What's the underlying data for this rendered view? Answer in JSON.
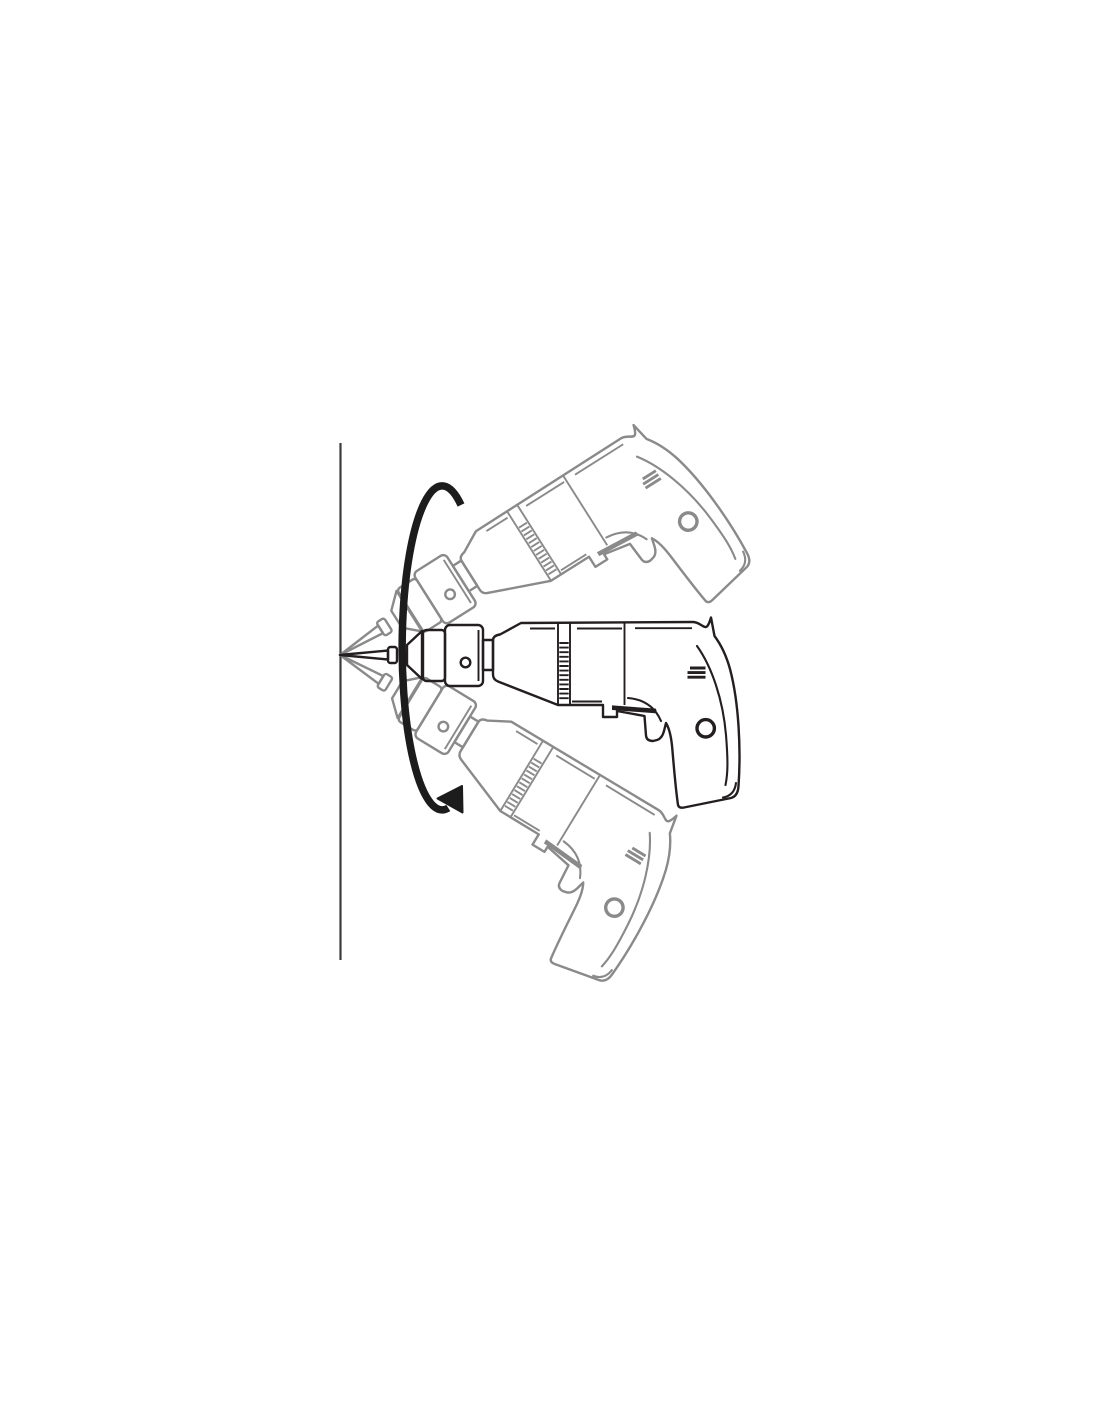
{
  "illustration": {
    "subject": "power-drill-pivot-diagram",
    "description": "Line drawing of an electric hand drill with its bit tip held against a vertical wall; the drill is shown level (solid outline) and in two ghosted tilted positions pivoting about the bit contact point, with a curved arrow indicating the up-and-down sweeping motion.",
    "positions": [
      {
        "id": "upper-ghost",
        "style": "ghost-outline",
        "rotation_deg": -32.3
      },
      {
        "id": "level-active",
        "style": "solid-outline",
        "rotation_deg": 0
      },
      {
        "id": "lower-ghost",
        "style": "ghost-outline",
        "rotation_deg": 31.3
      }
    ],
    "colors": {
      "background": "#ffffff",
      "wall": "#3c3c3c",
      "active_drill": "#231f20",
      "ghost_drill": "#8a8a8a",
      "arrow": "#1c1c1c"
    }
  }
}
